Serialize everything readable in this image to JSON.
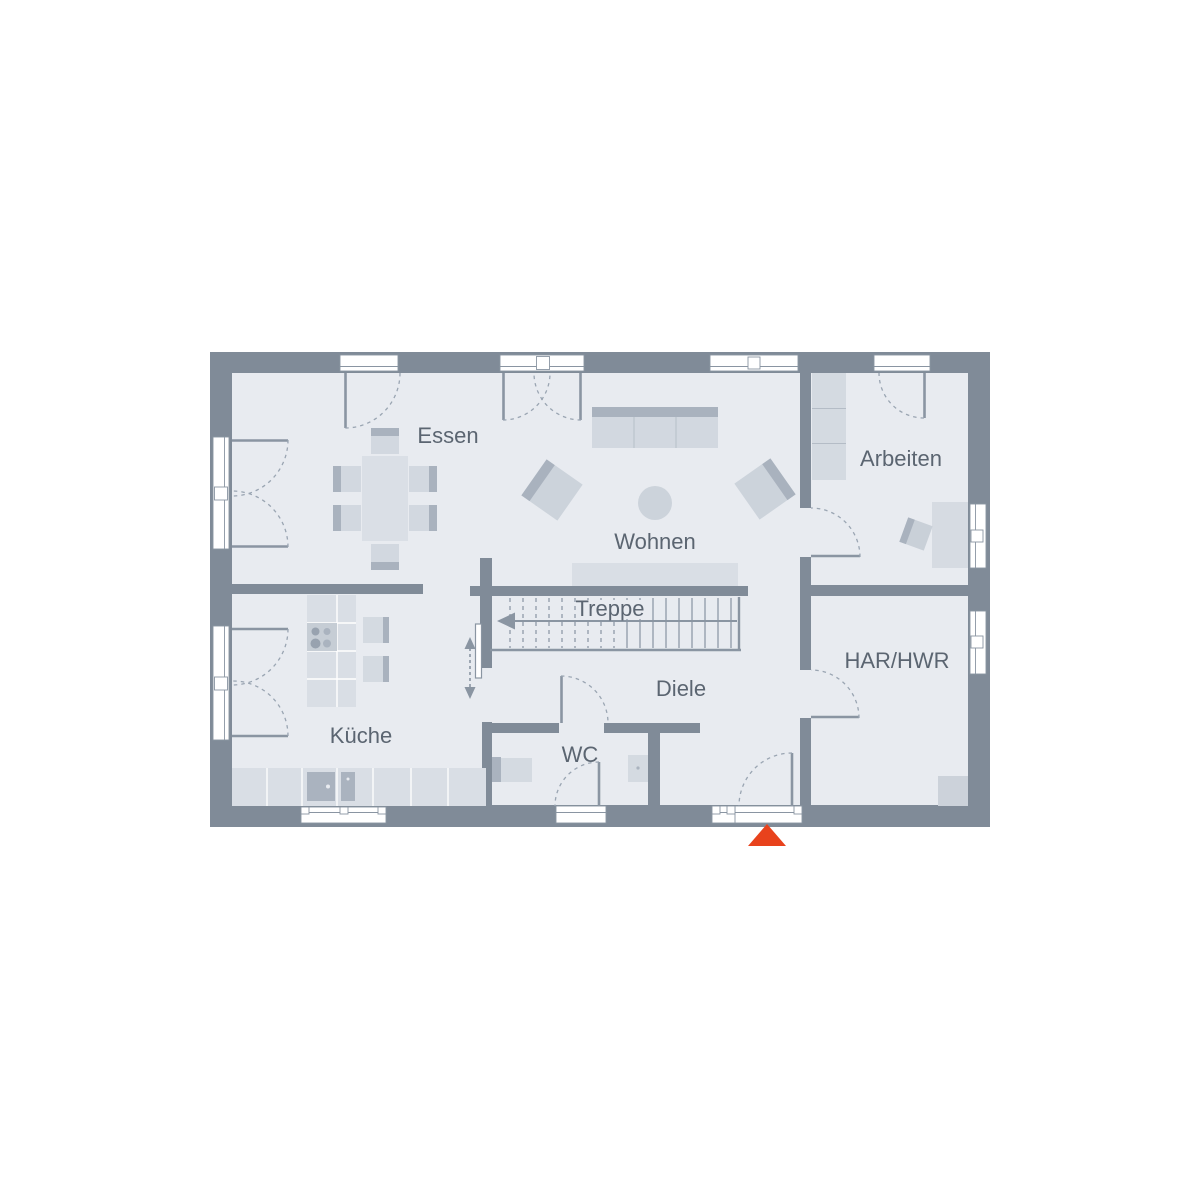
{
  "plan": {
    "type": "floor-plan",
    "rooms": {
      "essen": {
        "label": "Essen"
      },
      "wohnen": {
        "label": "Wohnen"
      },
      "arbeiten": {
        "label": "Arbeiten"
      },
      "kueche": {
        "label": "Küche"
      },
      "treppe": {
        "label": "Treppe"
      },
      "diele": {
        "label": "Diele"
      },
      "wc": {
        "label": "WC"
      },
      "har_hwr": {
        "label": "HAR/HWR"
      }
    },
    "icons": {
      "entrance_arrow": "triangle-up",
      "stair_direction": "arrow-left",
      "sliding_door_direction": "double-arrow-vertical"
    },
    "colors": {
      "wall": "#808b98",
      "floor": "#e8ebf0",
      "furniture_light": "#d6dbe2",
      "furniture_accent": "#aab3bf",
      "label_text": "#5b6571",
      "entrance_arrow": "#e8421c"
    }
  }
}
